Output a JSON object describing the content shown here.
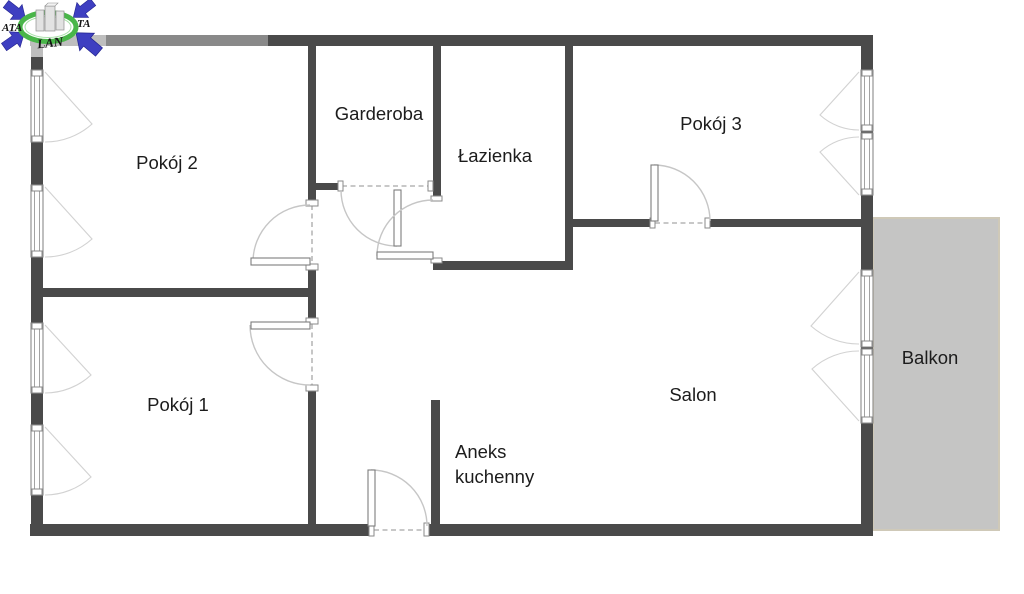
{
  "rooms": {
    "pokoj2": {
      "label": "Pokój 2"
    },
    "garderoba": {
      "label": "Garderoba"
    },
    "lazienka": {
      "label": "Łazienka"
    },
    "pokoj3": {
      "label": "Pokój 3"
    },
    "pokoj1": {
      "label": "Pokój 1"
    },
    "salon": {
      "label": "Salon"
    },
    "aneks": {
      "label_lines": [
        "Aneks",
        "kuchenny"
      ]
    },
    "balkon": {
      "label": "Balkon"
    }
  },
  "logo": {
    "text_left": "ATA",
    "text_right": "TA",
    "text_bottom": "LAN"
  },
  "colors": {
    "wall": "#4a4a4a",
    "door_arc": "#c6c6c6",
    "window_frame": "#8a8a8a",
    "balcony_fill": "#c5c5c4",
    "balcony_border": "#cfc9b8",
    "label_text": "#1c1c1c",
    "logo_blue": "#3e3fc1",
    "logo_green": "#49b649"
  }
}
